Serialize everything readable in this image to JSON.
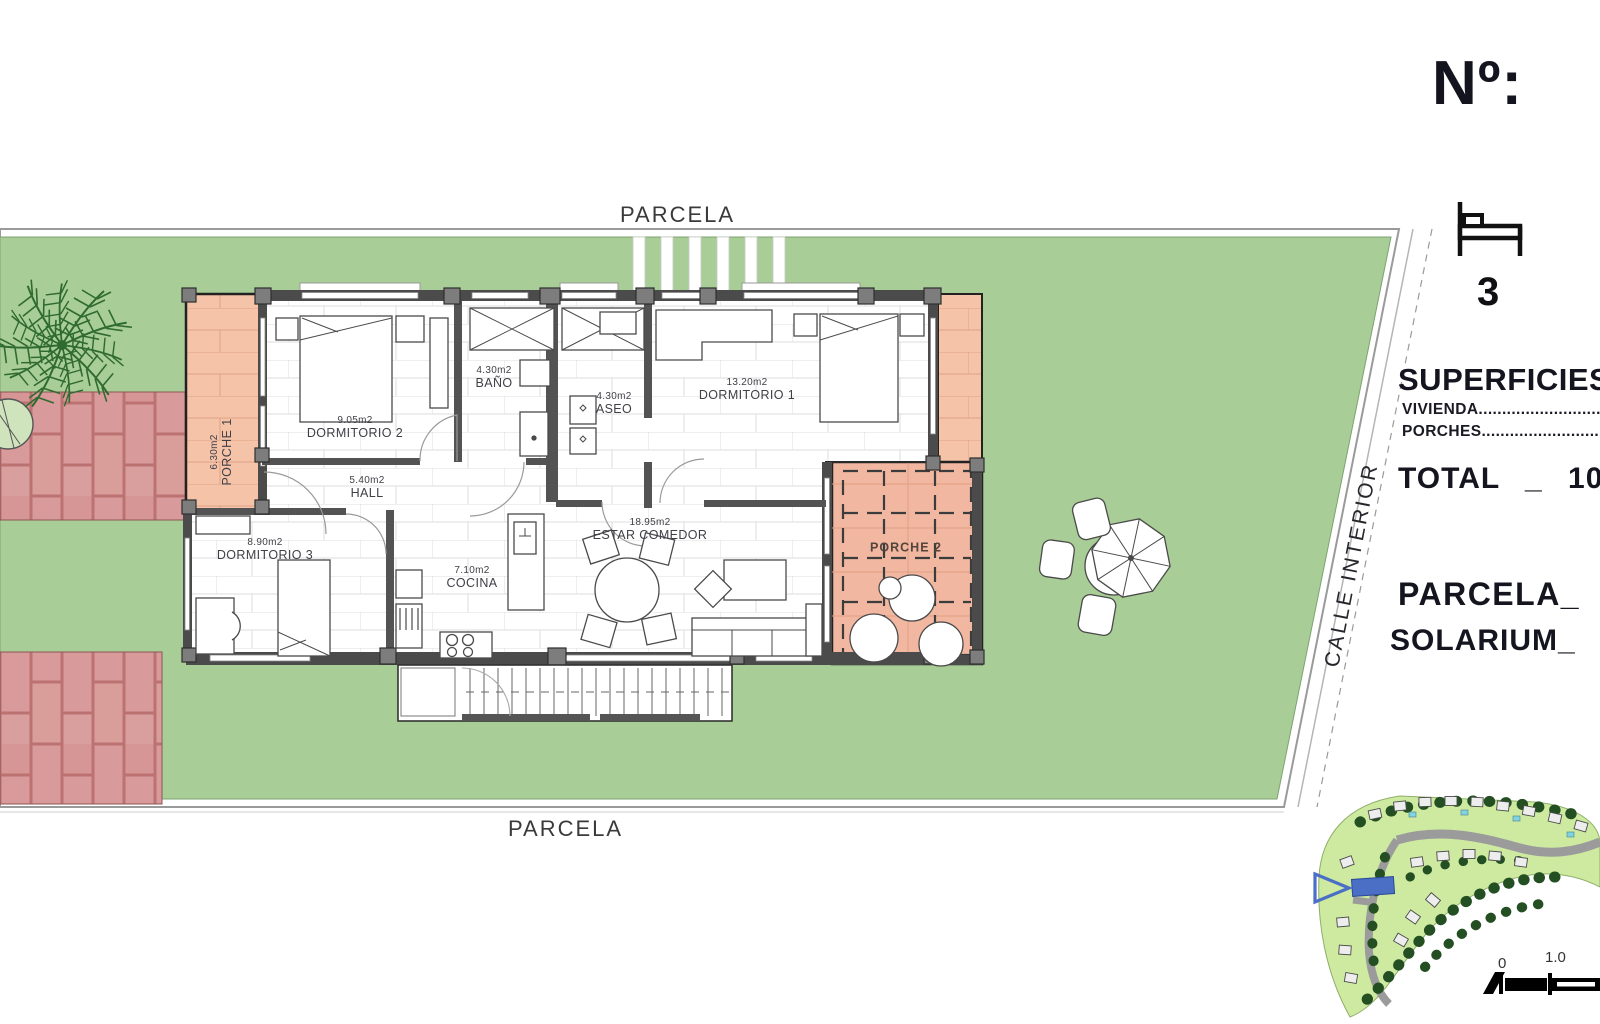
{
  "header": {
    "number_label": "Nº:",
    "bedrooms": "3"
  },
  "panel": {
    "superficie_title": "SUPERFICIES",
    "vivienda_label": "VIVIENDA.......................................",
    "porches_label": "PORCHES.......................................",
    "total_label": "TOTAL _ 10",
    "parcela_label": "PARCELA_",
    "solarium_label": "SOLARIUM_"
  },
  "site": {
    "parcela_top": "PARCELA",
    "parcela_bottom": "PARCELA",
    "calle_interior": "CALLE INTERIOR"
  },
  "rooms": [
    {
      "id": "dormitorio2",
      "area": "9.05m2",
      "name": "DORMITORIO 2"
    },
    {
      "id": "bano",
      "area": "4.30m2",
      "name": "BAÑO"
    },
    {
      "id": "aseo",
      "area": "4.30m2",
      "name": "ASEO"
    },
    {
      "id": "dormitorio1",
      "area": "13.20m2",
      "name": "DORMITORIO 1"
    },
    {
      "id": "hall",
      "area": "5.40m2",
      "name": "HALL"
    },
    {
      "id": "dormitorio3",
      "area": "8.90m2",
      "name": "DORMITORIO 3"
    },
    {
      "id": "cocina",
      "area": "7.10m2",
      "name": "COCINA"
    },
    {
      "id": "estar",
      "area": "18.95m2",
      "name": "ESTAR COMEDOR"
    },
    {
      "id": "porche1",
      "area": "6.30m2",
      "name": "PORCHE 1"
    },
    {
      "id": "porche2",
      "area": "",
      "name": "PORCHE 2"
    }
  ],
  "scale_bar": {
    "zero": "0",
    "one": "1.0"
  },
  "colors": {
    "lawn": "#a9cd96",
    "porch": "#f4c3a8",
    "brick": "#d89a9a",
    "wall": "#4b4b4b",
    "plot_highlight": "#4a6fc4"
  }
}
